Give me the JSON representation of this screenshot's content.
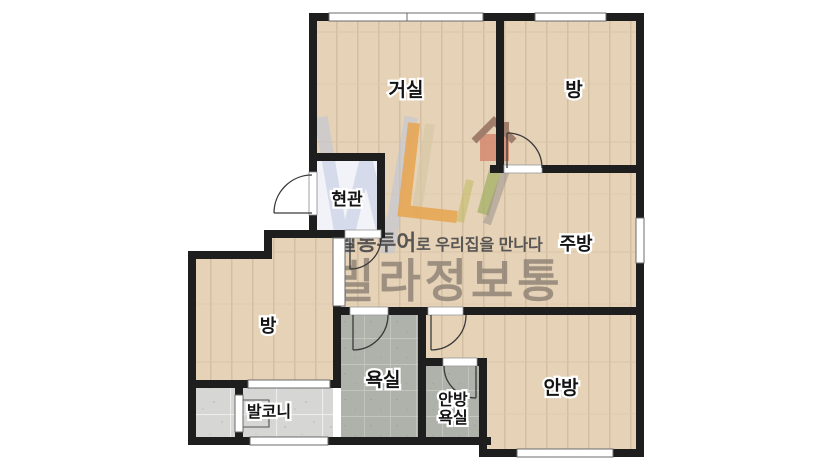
{
  "floorplan": {
    "labels": {
      "living": "거실",
      "bedroom_top": "방",
      "entrance": "현관",
      "kitchen": "주방",
      "bedroom_left": "방",
      "bathroom": "욕실",
      "master_bathroom_line1": "안방",
      "master_bathroom_line2": "욕실",
      "master_bedroom": "안방",
      "balcony": "발코니"
    },
    "watermark": {
      "brand": "빌라정보통",
      "slogan_emphasis": "빌통투어",
      "slogan_rest": "로 우리집을 만나다"
    },
    "colors": {
      "wall": "#1e1e1e",
      "wood_floor": "#e5d2b7",
      "bath_tile": "#afb2ab",
      "balcony_tile": "#d6d6d5",
      "entrance_floor": "#f2f3f8",
      "brand_text": "#8b7e72",
      "slogan_text": "#4b4b4b",
      "logo_blue": "#b9c3de",
      "logo_orange": "#e8a44f",
      "logo_green": "#a8b26a",
      "logo_house_body": "#d68a70",
      "logo_house_roof": "#96705f",
      "door_arc": "#3a3a3a"
    }
  }
}
